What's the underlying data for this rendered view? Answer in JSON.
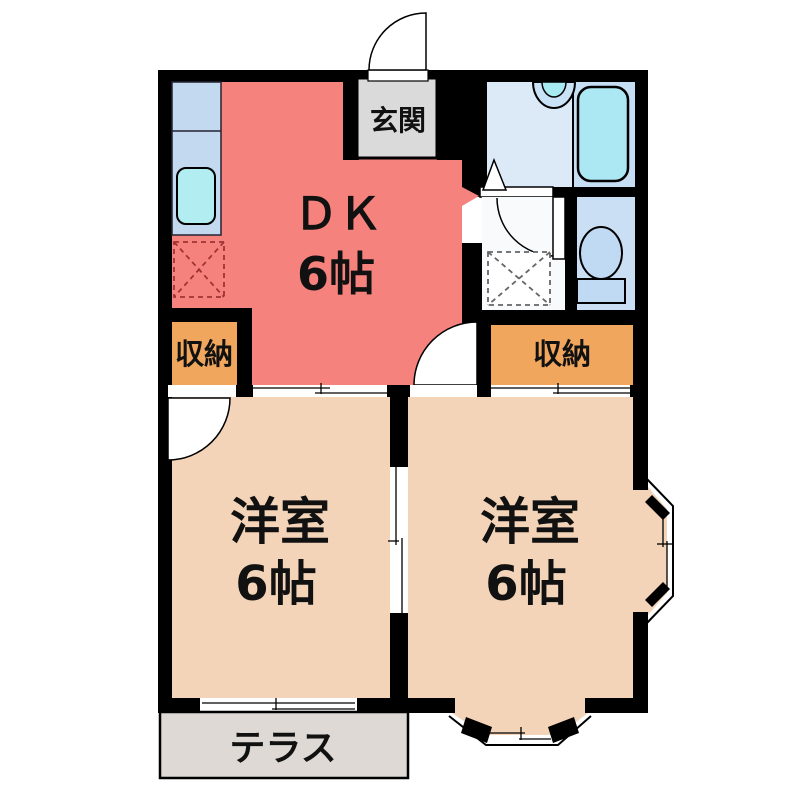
{
  "plan": {
    "title": "2DK apartment floor plan",
    "rooms": {
      "dk": {
        "label": "ＤＫ",
        "size": "6帖"
      },
      "entrance": {
        "label": "玄関"
      },
      "closet_left": {
        "label": "収納"
      },
      "closet_right": {
        "label": "収納"
      },
      "western_left": {
        "label": "洋室",
        "size": "6帖"
      },
      "western_right": {
        "label": "洋室",
        "size": "6帖"
      },
      "terrace": {
        "label": "テラス"
      }
    },
    "fixtures": {
      "kitchen_counter": "kitchen counter with sink",
      "refrigerator_space": "dashed box (refrigerator space)",
      "washing_machine_space": "dashed box (washing machine space)",
      "bathtub": "bathtub",
      "washbasin": "washbasin",
      "toilet": "toilet"
    },
    "colors": {
      "wall": "#000000",
      "dk_floor": "#F6827E",
      "western_floor": "#F3D4B8",
      "closet_floor": "#F0A65C",
      "entrance_floor": "#DADADA",
      "terrace_floor": "#DED9D4",
      "bath_floor_left": "#DCEAF8",
      "bath_floor_right": "#C6DEF4",
      "bathtub_fill": "#ACE7F4",
      "counter_fill": "#C2D9F0",
      "sink_fill": "#B2EDF2",
      "toilet_floor": "#CADEF4",
      "toilet_fill": "#C0DAF3",
      "washroom_floor": "#F8FAFC",
      "washbasin_outer": "#C9E2F5",
      "washbasin_inner": "#A8EAF2"
    }
  }
}
